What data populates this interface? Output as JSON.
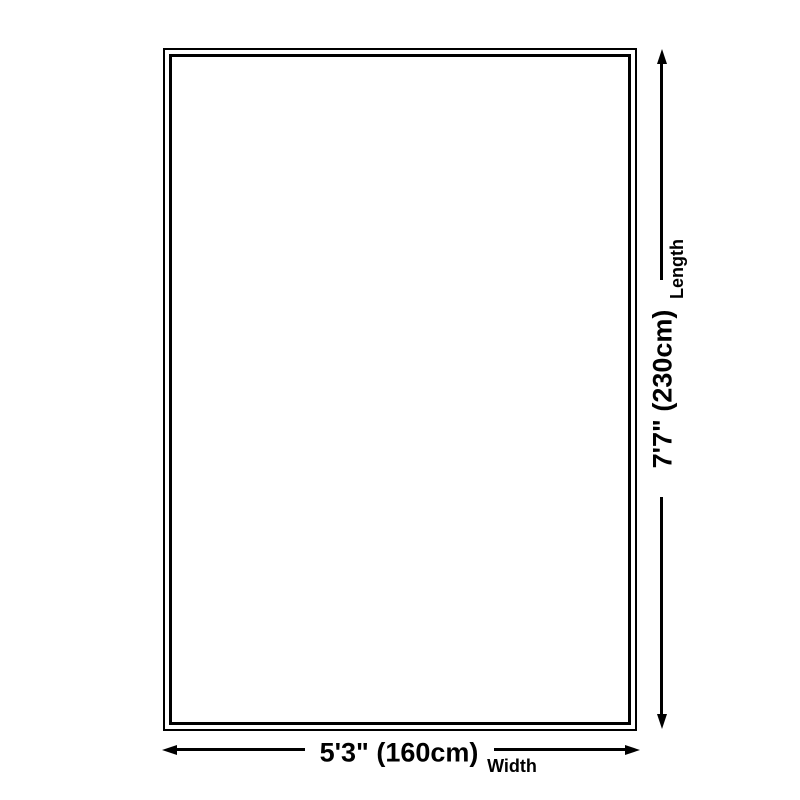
{
  "diagram": {
    "type": "product-dimension-diagram",
    "background_color": "#ffffff",
    "line_color": "#000000",
    "dimensions": {
      "length": {
        "value": "7'7\" (230cm)",
        "label": "Length"
      },
      "width": {
        "value": "5'3\" (160cm)",
        "label": "Width"
      }
    }
  }
}
